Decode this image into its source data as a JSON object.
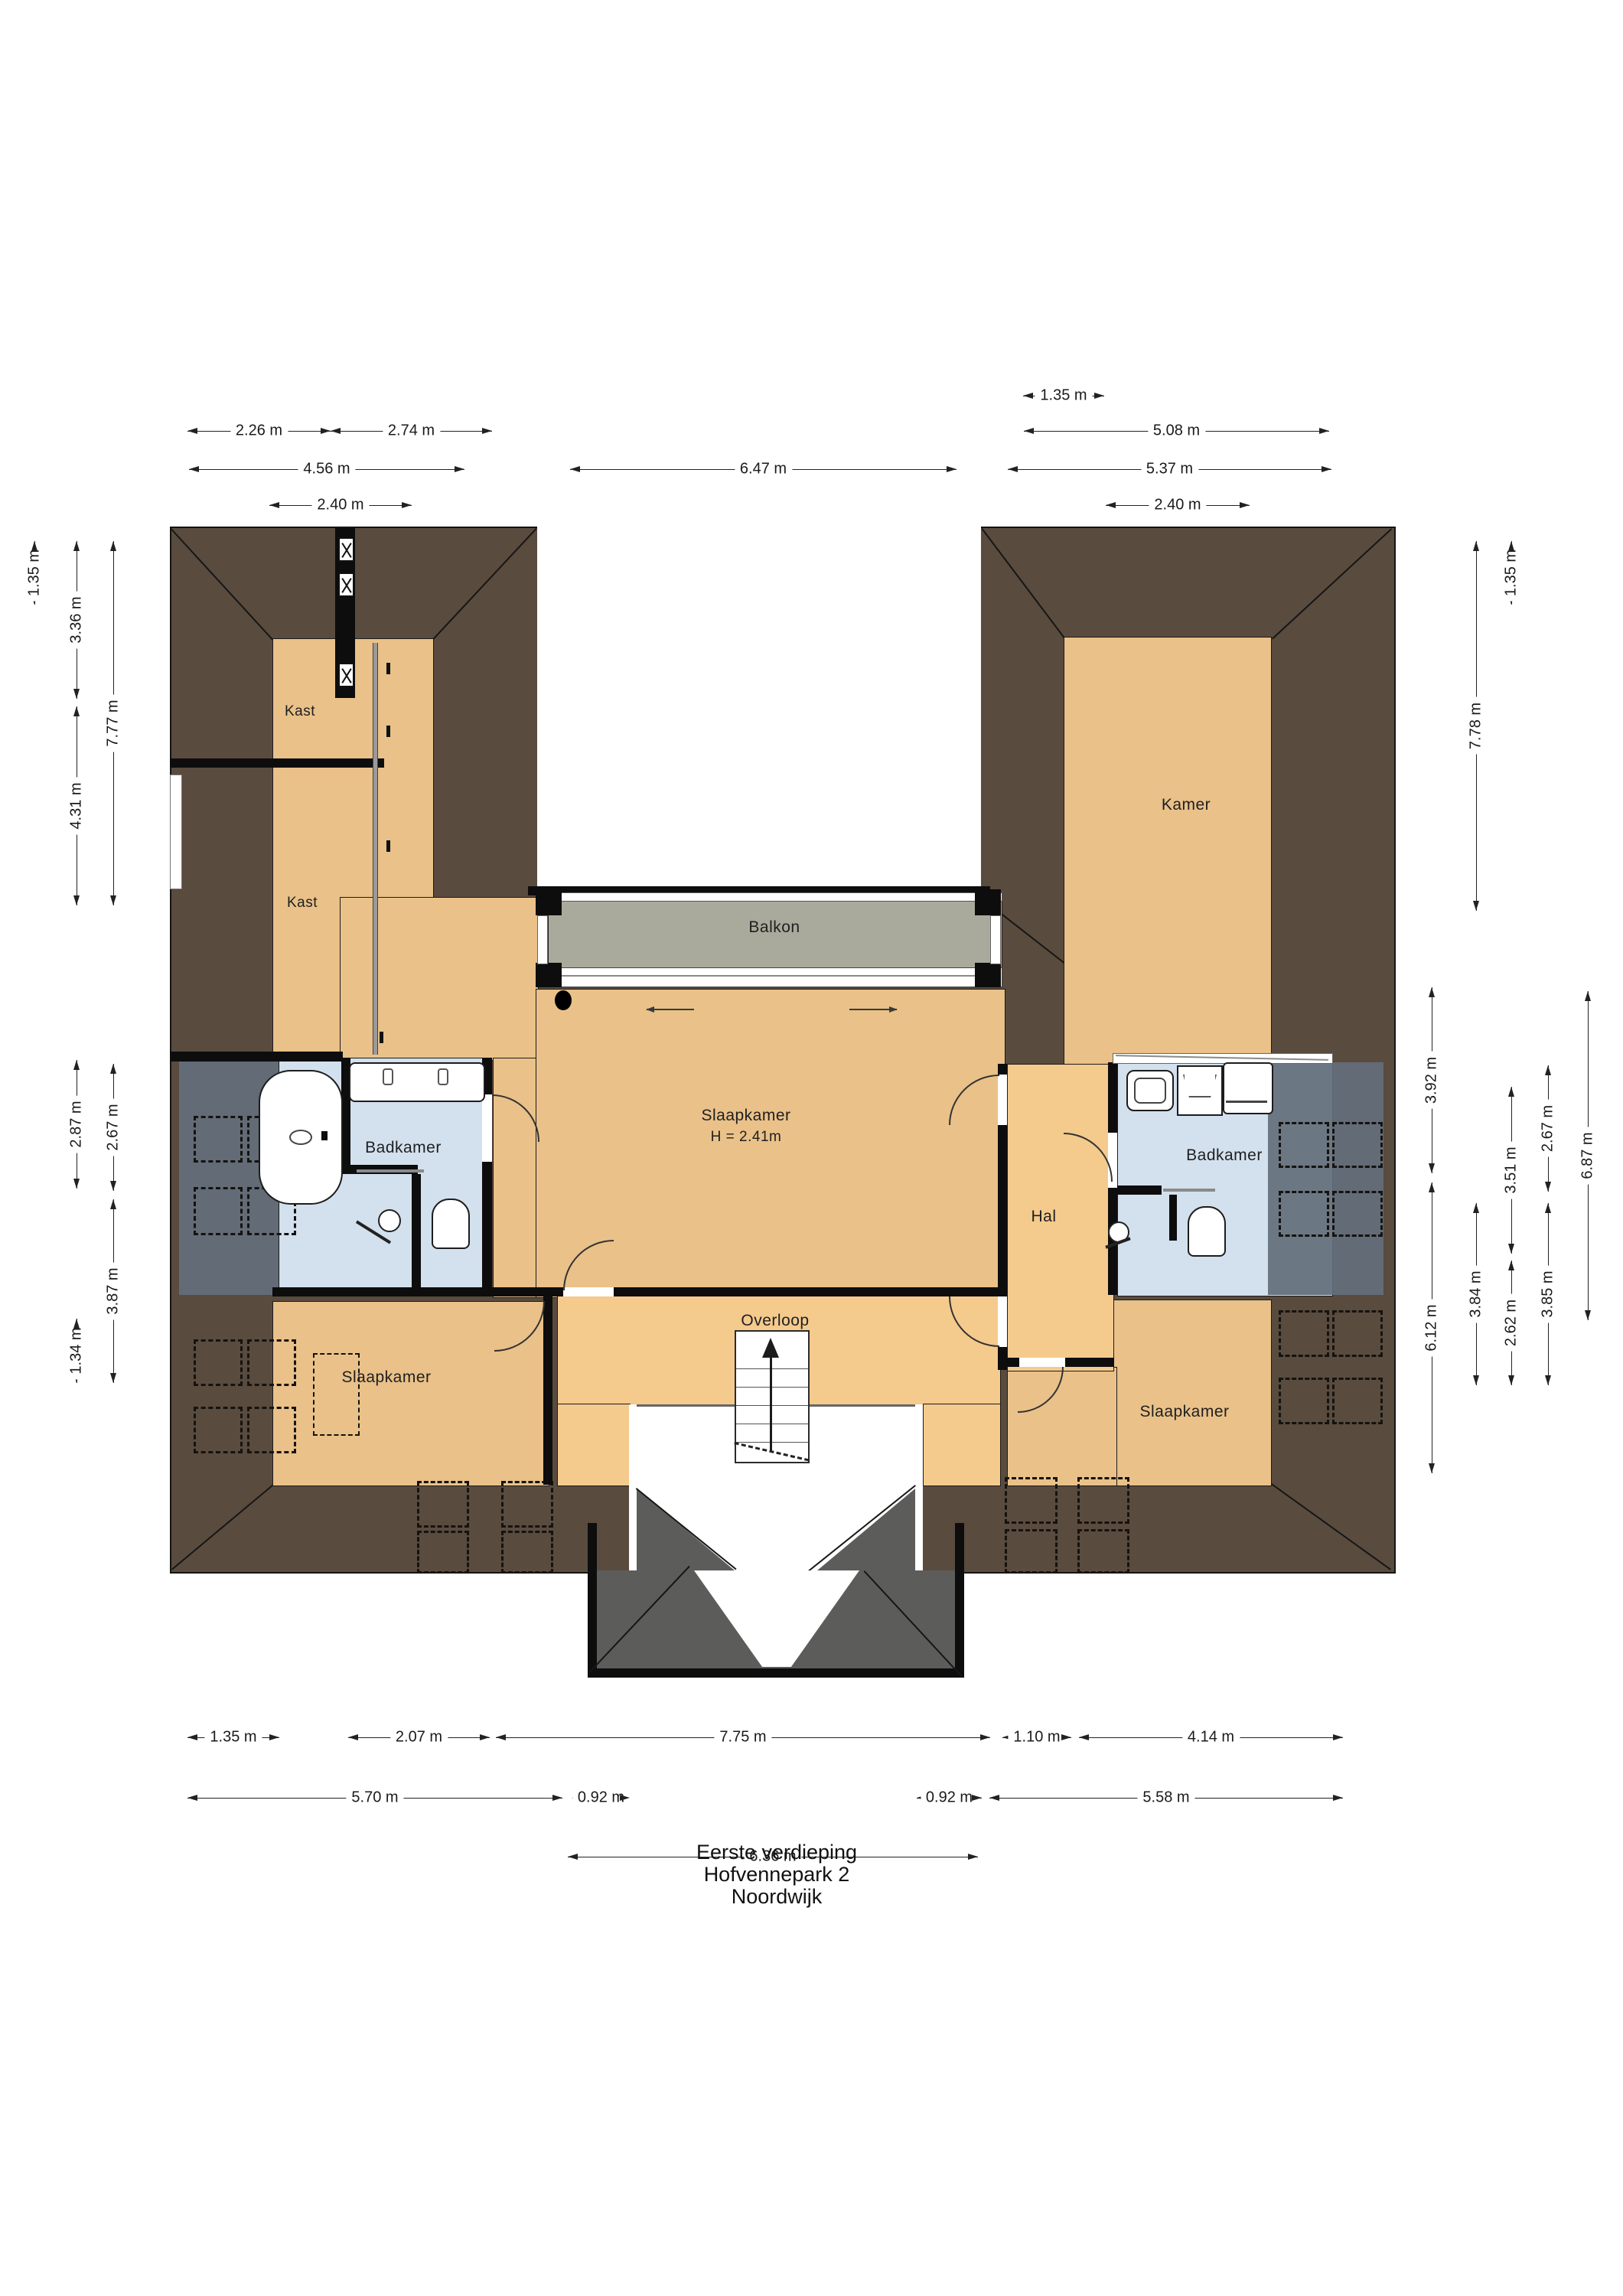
{
  "title": {
    "lines": [
      "Eerste verdieping",
      "Hofvennepark 2",
      "Noordwijk"
    ]
  },
  "rooms": {
    "kast_top": "Kast",
    "kast_bottom": "Kast",
    "kamer": "Kamer",
    "balkon": "Balkon",
    "slaapkamer_center": "Slaapkamer",
    "slaapkamer_center_height": "H = 2.41m",
    "badkamer_left": "Badkamer",
    "badkamer_right": "Badkamer",
    "hal": "Hal",
    "overloop": "Overloop",
    "slaapkamer_left": "Slaapkamer",
    "slaapkamer_right": "Slaapkamer"
  },
  "dimensions": {
    "top": [
      "1.35 m",
      "2.26 m",
      "2.74 m",
      "5.08 m",
      "4.56 m",
      "6.47 m",
      "5.37 m",
      "2.40 m",
      "2.40 m"
    ],
    "left": [
      "1.35 m",
      "3.36 m",
      "4.31 m",
      "2.87 m",
      "1.34 m",
      "7.77 m",
      "2.67 m",
      "3.87 m"
    ],
    "right": [
      "1.35 m",
      "7.78 m",
      "3.92 m",
      "6.12 m",
      "3.84 m",
      "3.51 m",
      "2.62 m",
      "2.67 m",
      "3.85 m",
      "6.87 m"
    ],
    "bottom": [
      "1.35 m",
      "2.07 m",
      "7.75 m",
      "1.10 m",
      "4.14 m",
      "5.70 m",
      "0.92 m",
      "0.92 m",
      "5.58 m",
      "6.36 m"
    ]
  },
  "colors": {
    "roof_dark": "#594b3e",
    "roof_gray": "#5c5c5a",
    "floor_tan": "#e9c189",
    "floor_circulation": "#f4ca8d",
    "bathroom_blue": "#d3e0ee",
    "roof_over_room_gray": "#636e7b",
    "balcony_gray": "#a9aa9b",
    "wall_black": "#0d0d0d",
    "dimension_line": "#222222"
  }
}
